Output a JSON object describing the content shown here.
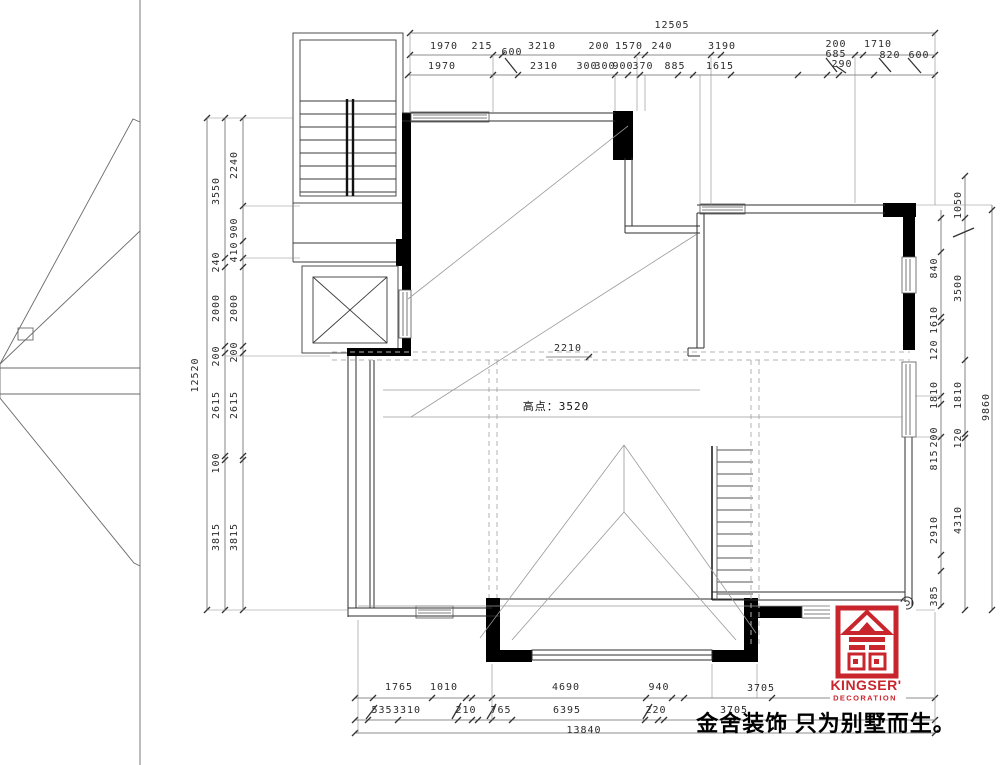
{
  "drawing": {
    "type": "roof-level floor plan",
    "line_color": "#333333",
    "accent_color": "#c9252c"
  },
  "dims": {
    "top": {
      "total": "12505",
      "row2": [
        "1970",
        "215",
        "3210",
        "200",
        "1570",
        "240",
        "3190",
        "200",
        "1710"
      ],
      "row2b": [
        "600",
        "685",
        "820",
        "600",
        "290"
      ],
      "row3": [
        "1970",
        "2310",
        "300",
        "300",
        "900",
        "370",
        "885",
        "1615"
      ]
    },
    "left": {
      "total": "12520",
      "mid": [
        "3550",
        "240",
        "2000",
        "200",
        "2615",
        "100",
        "3815"
      ],
      "inner": [
        "2240",
        "900",
        "410",
        "2000",
        "200",
        "2615",
        "3815"
      ]
    },
    "right": {
      "total": "9860",
      "mid": [
        "1050",
        "3500",
        "1810",
        "120",
        "4310"
      ],
      "inner": [
        "840",
        "1610",
        "120",
        "1810",
        "200",
        "815",
        "2910",
        "385"
      ]
    },
    "bottom": {
      "total": "13840",
      "row1": [
        "1765",
        "1010",
        "4690",
        "940",
        "3705"
      ],
      "row2": [
        "535",
        "3310",
        "210",
        "765",
        "6395",
        "220",
        "3705"
      ]
    }
  },
  "annotations": {
    "ridge": "2210",
    "high_point": "高点：3520"
  },
  "logo": {
    "brand": "KINGSER'",
    "division": "DECORATION",
    "slogan": "金舍装饰 只为别墅而生。",
    "color": "#c9252c"
  }
}
